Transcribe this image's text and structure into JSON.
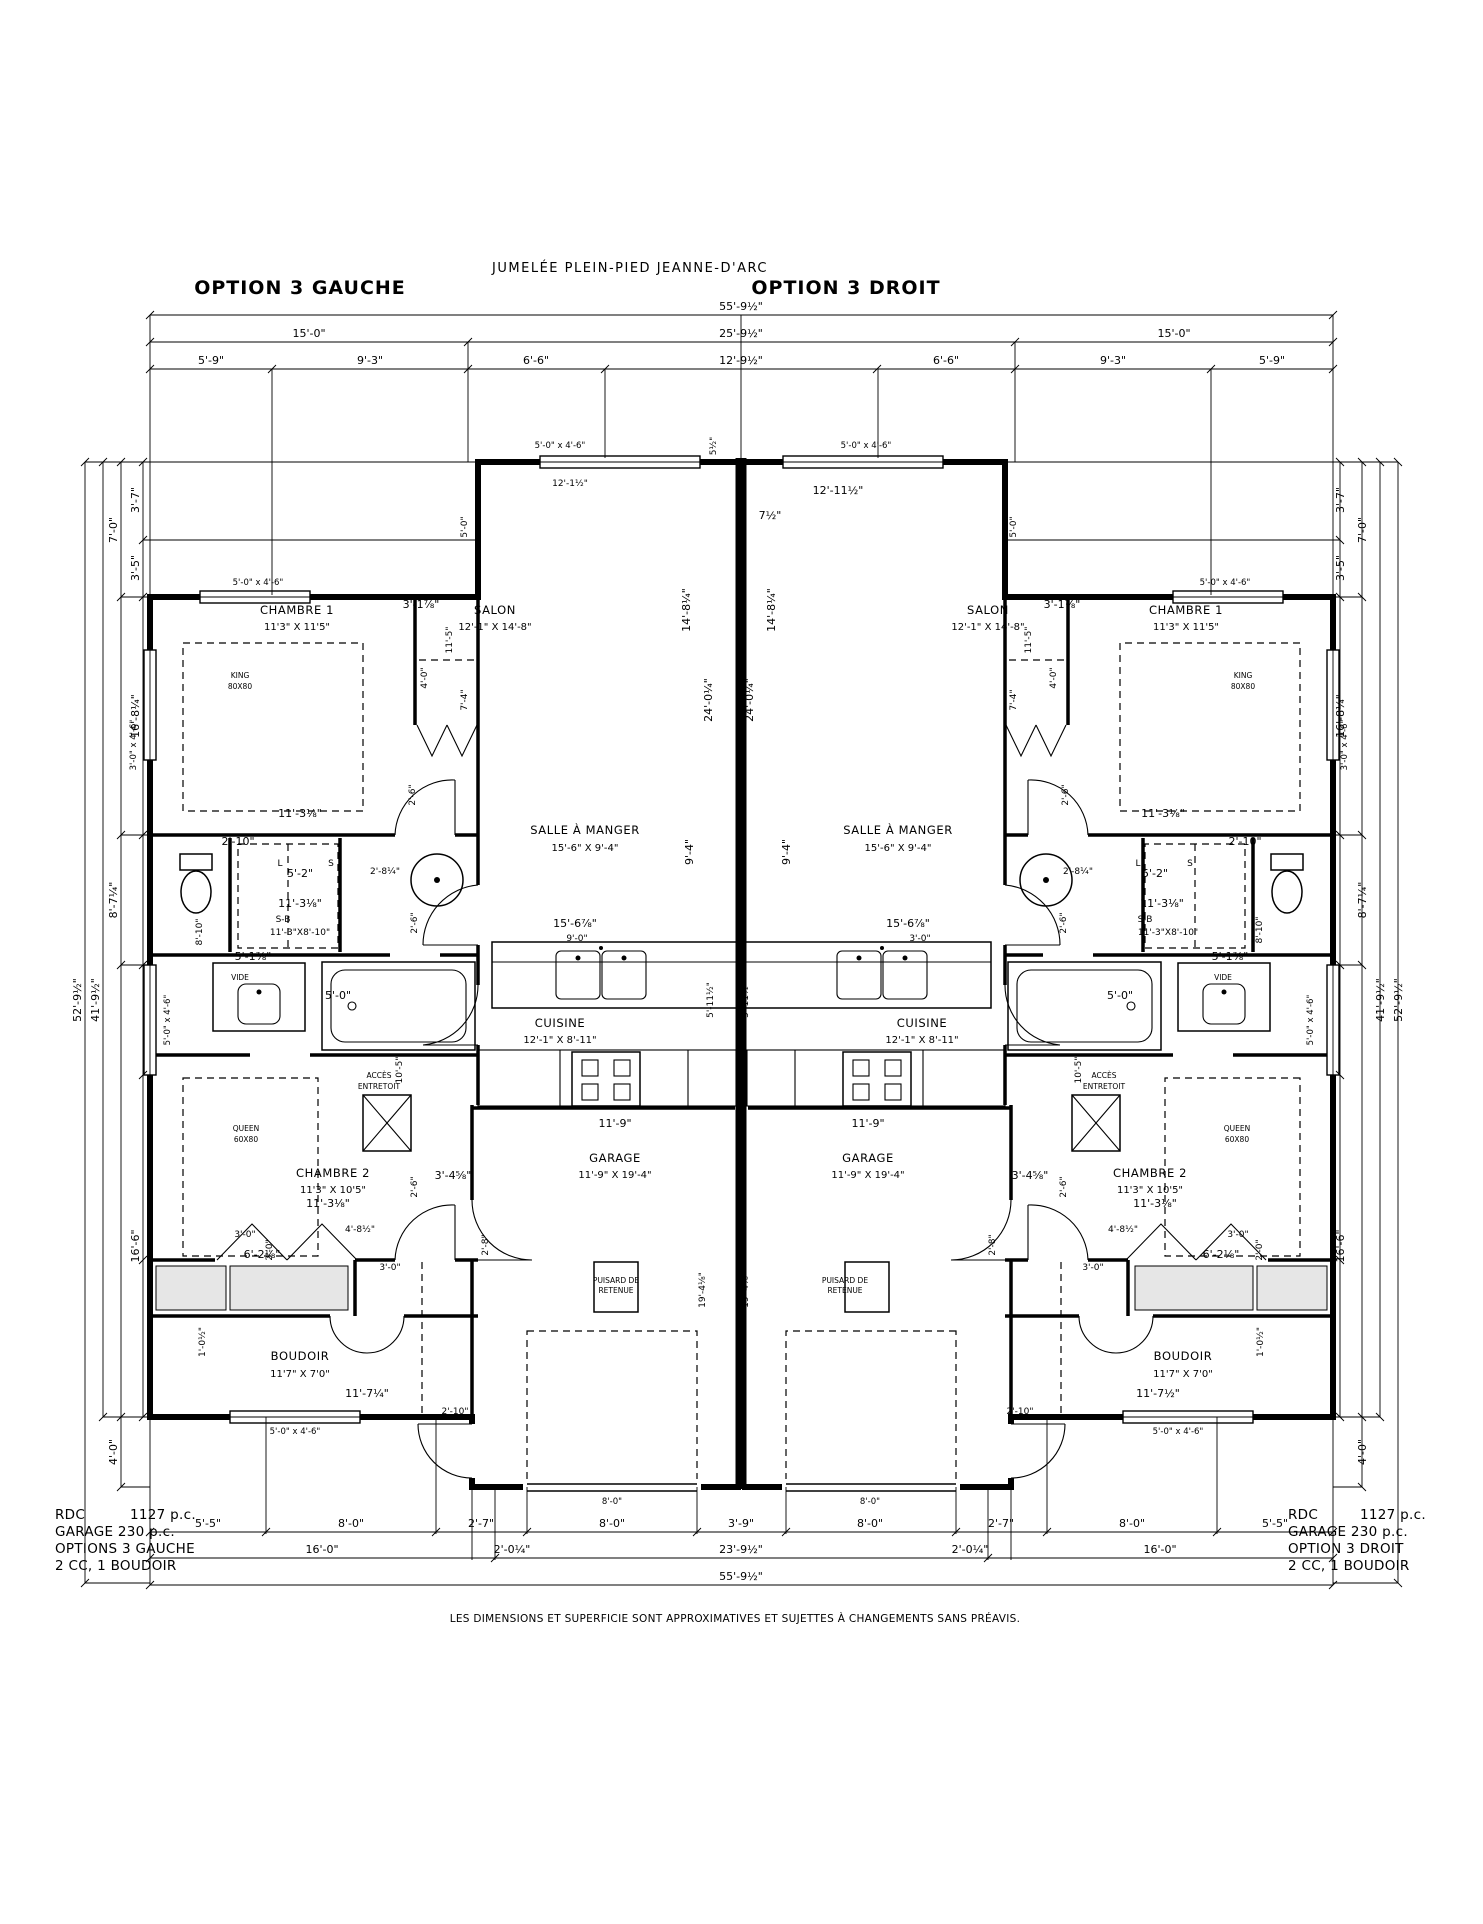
{
  "header": {
    "title": "JUMELÉE PLEIN-PIED JEANNE-D'ARC",
    "option_left": "OPTION 3 GAUCHE",
    "option_right": "OPTION 3 DROIT"
  },
  "rooms": {
    "chambre1": "CHAMBRE 1",
    "chambre1_size": "11'3\" X 11'5\"",
    "salon": "SALON",
    "salon_size": "12'-1\" X 14'-8\"",
    "salle_a_manger": "SALLE À MANGER",
    "salle_a_manger_size": "15'-6\" X 9'-4\"",
    "cuisine": "CUISINE",
    "cuisine_size": "12'-1\" X 8'-11\"",
    "garage": "GARAGE",
    "garage_size": "11'-9\" X 19'-4\"",
    "chambre2": "CHAMBRE 2",
    "chambre2_size": "11'3\" X 10'5\"",
    "boudoir": "BOUDOIR",
    "boudoir_size": "11'7\" X 7'0\"",
    "sdb": "S-B",
    "sdb_size": "11'-3\"X8'-10\""
  },
  "fixtures": {
    "king": "KING",
    "king_size": "80X80",
    "queen": "QUEEN",
    "queen_size": "60X80",
    "acces_line1": "ACCÈS",
    "acces_line2": "ENTRETOIT",
    "puisard_line1": "PUISARD DE",
    "puisard_line2": "RETENUE",
    "vide": "VIDE",
    "laveuse": "L",
    "secheuse": "S"
  },
  "windows": {
    "w5046": "5'-0\" x 4'-6\"",
    "w3046": "3'-0\" x 4'-6\""
  },
  "dims": {
    "d55_9h": "55'-9½\"",
    "d25_9h": "25'-9½\"",
    "d23_9h": "23'-9½\"",
    "d16_0": "16'-0\"",
    "d15_0": "15'-0\"",
    "d12_9h": "12'-9½\"",
    "d12_1h": "12'-1½\"",
    "d12_11h": "12'-11½\"",
    "d11_9": "11'-9\"",
    "d11_5": "11'-5\"",
    "d11_3e": "11'-3⅛\"",
    "d11_7q": "11'-7¼\"",
    "d11_7h": "11'-7½\"",
    "d10_5": "10'-5\"",
    "d9_3": "9'-3\"",
    "d9_4": "9'-4\"",
    "d9_0": "9'-0\"",
    "d8_0": "8'-0\"",
    "d8_10": "8'-10\"",
    "d8_7q": "8'-7¼\"",
    "d7_0": "7'-0\"",
    "d7_4": "7'-4\"",
    "d7h": "7½\"",
    "d6_6": "6'-6\"",
    "d6_2e": "6'-2⅛\"",
    "d5_9": "5'-9\"",
    "d5_5": "5'-5\"",
    "d5_2": "5'-2\"",
    "d5_0": "5'-0\"",
    "d5_11h": "5'-11½\"",
    "d5_1e": "5'-1⅞\"",
    "d5h": "5½\"",
    "d4_0": "4'-0\"",
    "d4_8h": "4'-8½\"",
    "d3_9": "3'-9\"",
    "d3_7": "3'-7\"",
    "d3_5": "3'-5\"",
    "d3_4e": "3'-4⅝\"",
    "d3_1e": "3'-1⅞\"",
    "d3_0": "3'-0\"",
    "d2_10": "2'-10\"",
    "d2_8": "2'-8\"",
    "d2_8q": "2'-8¼\"",
    "d2_7": "2'-7\"",
    "d2_6": "2'-6\"",
    "d2_0": "2'-0\"",
    "d2_0q": "2'-0¼\"",
    "d1_0h": "1'-0½\"",
    "d52_9h": "52'-9½\"",
    "d41_9h": "41'-9½\"",
    "d16_8q": "16'-8¼\"",
    "d16_6": "16'-6\"",
    "d14_8q": "14'-8¼\"",
    "d24_0q": "24'-0¼\"",
    "d19_4e": "19'-4⅛\"",
    "d15_6e": "15'-6⅞\""
  },
  "footer": {
    "rdc_label": "RDC",
    "rdc_value": "1127 p.c.",
    "garage_line": "GARAGE 230 p.c.",
    "option_left": "OPTIONS 3 GAUCHE",
    "option_right": "OPTION 3 DROIT",
    "config": "2 CC, 1 BOUDOIR",
    "disclaimer": "LES DIMENSIONS ET SUPERFICIE SONT APPROXIMATIVES ET SUJETTES À CHANGEMENTS SANS PRÉAVIS."
  }
}
